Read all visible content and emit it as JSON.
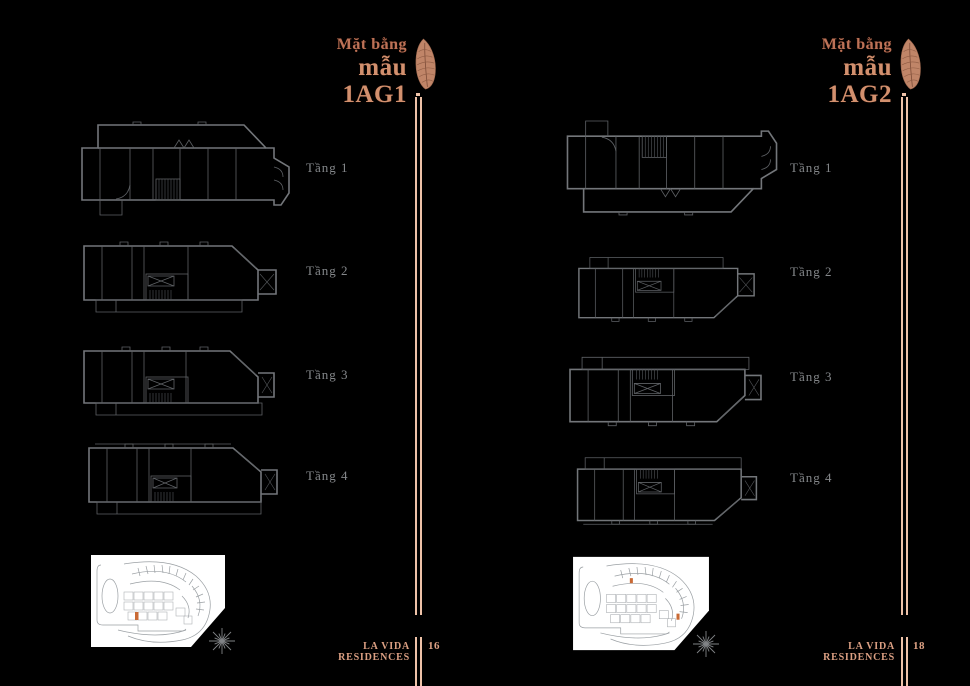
{
  "document": {
    "kind": "floor-plan brochure spread",
    "background_color": "#000000"
  },
  "colors": {
    "copper_title_small": "#bd7257",
    "copper_title_large": "#d2906e",
    "copper_divider": "#eec2a8",
    "copper_footer": "#dca083",
    "plan_line_gray": "#73767a",
    "floor_label_gray": "#85888b",
    "site_map_panel": "#ffffff",
    "lot_highlight_orange": "#c96a35"
  },
  "icons": {
    "feather": "feather-plume-icon",
    "compass": "compass-starburst-icon"
  },
  "pages": [
    {
      "title": {
        "line1": "Mặt bằng",
        "line2": "mẫu 1AG1"
      },
      "floor_labels": [
        "Tầng 1",
        "Tầng 2",
        "Tầng 3",
        "Tầng 4"
      ],
      "footer": {
        "brand": "LA VIDA RESIDENCES",
        "page_number": "16"
      }
    },
    {
      "title": {
        "line1": "Mặt bằng",
        "line2": "mẫu 1AG2"
      },
      "floor_labels": [
        "Tầng 1",
        "Tầng 2",
        "Tầng 3",
        "Tầng 4"
      ],
      "footer": {
        "brand": "LA VIDA RESIDENCES",
        "page_number": "18"
      }
    }
  ]
}
